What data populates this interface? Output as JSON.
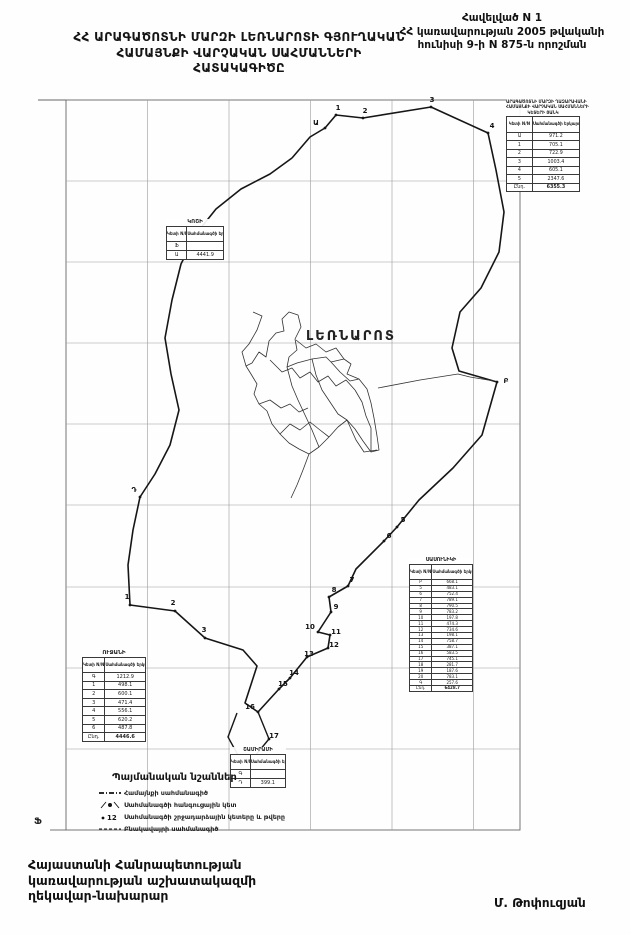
{
  "colors": {
    "ink": "#161616",
    "grid": "#999999",
    "thin": "#333333"
  },
  "header": {
    "appendix": {
      "line1": "Հավելված N 1",
      "line2": "ՀՀ կառավարության 2005 թվականի",
      "line3": "հունիսի 9-ի N 875-ն որոշման"
    },
    "title": {
      "line1": "ՀՀ ԱՐԱԳԱԾՈՏՆԻ ՄԱՐԶԻ ԼԵՌՆԱՐՈՏԻ ԳՅՈՒՂԱԿԱՆ",
      "line2": "ՀԱՄԱՅՆՔԻ ՎԱՐՉԱԿԱՆ ՍԱՀՄԱՆՆԵՐԻ",
      "line3": "ՀԱՏԱԿԱԳԻԾԸ"
    }
  },
  "map": {
    "settlement_label": "ԼԵՌՆԱՐՈՏ",
    "corner_mark": "Ֆ",
    "tables": [
      {
        "id": "t1",
        "title_lines": [
          "ԱՐԱԳԱԾՈՏՆԻ ՄԱՐԶԻ ՂԱԶԱՐԱՎԱՆԻ",
          "ՀԱՄԱՅՆՔԻ ՎԱՐՉԱԿԱՆ ՍԱՀՄԱՆՆԵՐԻ",
          "ԿԵՏԵՐԻ ՑԱՆԿ"
        ],
        "col1": "Կետի N/N",
        "col2": "Սահմանագծի երկարությունը մ",
        "rows": [
          [
            "Ա",
            "971.2"
          ],
          [
            "1",
            "705.1"
          ],
          [
            "2",
            "722.9"
          ],
          [
            "3",
            "1003.4"
          ],
          [
            "4",
            "605.1"
          ],
          [
            "5",
            "2347.6"
          ]
        ],
        "total_label": "Ընդ.",
        "total": "6355.3"
      },
      {
        "id": "t2",
        "title_lines": [
          "ԿՈՇԻ"
        ],
        "col1": "Կետի N/N",
        "col2": "Սահմանագծի երկարությունը մ",
        "rows": [
          [
            "Ֆ",
            ""
          ],
          [
            "Ա",
            "4441.9"
          ]
        ],
        "total_label": "",
        "total": ""
      },
      {
        "id": "t3",
        "title_lines": [
          "ՍԱՍՈՒՆԻԿԻ"
        ],
        "col1": "Կետի N/N",
        "col2": "Սահմանագծի երկարությունը մ",
        "rows": [
          [
            "Բ",
            "668.1"
          ],
          [
            "5",
            "483.1"
          ],
          [
            "6",
            "752.4"
          ],
          [
            "7",
            "789.1"
          ],
          [
            "8",
            "790.5"
          ],
          [
            "9",
            "783.2"
          ],
          [
            "10",
            "197.8"
          ],
          [
            "11",
            "474.3"
          ],
          [
            "12",
            "734.6"
          ],
          [
            "13",
            "198.1"
          ],
          [
            "14",
            "758.7"
          ],
          [
            "15",
            "387.1"
          ],
          [
            "16",
            "583.5"
          ],
          [
            "17",
            "745.1"
          ],
          [
            "18",
            "281.7"
          ],
          [
            "19",
            "187.6"
          ],
          [
            "20",
            "783.1"
          ],
          [
            "Գ",
            "257.6"
          ]
        ],
        "total_label": "Ընդ.",
        "total": "6428.7"
      },
      {
        "id": "t4",
        "title_lines": [
          "ՈՒՋԱՆԻ"
        ],
        "col1": "Կետի N/N",
        "col2": "Սահմանագծի երկարությունը մ",
        "rows": [
          [
            "Գ",
            "1212.9"
          ],
          [
            "1",
            "498.1"
          ],
          [
            "2",
            "600.1"
          ],
          [
            "3",
            "471.4"
          ],
          [
            "4",
            "556.1"
          ],
          [
            "5",
            "620.2"
          ],
          [
            "6",
            "487.8"
          ]
        ],
        "total_label": "Ընդ.",
        "total": "4446.6"
      },
      {
        "id": "t5",
        "title_lines": [
          "ՇԱՄԻՐԱՄԻ"
        ],
        "col1": "Կետի N/N",
        "col2": "Սահմանագծի երկարությունը մ",
        "rows": [
          [
            "Գ",
            ""
          ],
          [
            "Դ",
            "399.1"
          ]
        ],
        "total_label": "",
        "total": ""
      }
    ],
    "legend": {
      "title": "Պայմանական նշաններ",
      "items": [
        {
          "symbol": "community-boundary-line-icon",
          "label": "Համայնքի սահմանագիծ"
        },
        {
          "symbol": "junction-point-icon",
          "label": "Սահմանագծի հանգուցային կետ"
        },
        {
          "symbol": "turning-point-number-icon",
          "label": "Սահմանագծի շրջադարձային կետերը և թվերը"
        },
        {
          "symbol": "settlement-boundary-line-icon",
          "label": "Բնակավայրի սահմանագիծ"
        }
      ]
    },
    "points": [
      {
        "label": "Ա",
        "x": 316,
        "y": 127
      },
      {
        "label": "1",
        "x": 338,
        "y": 112
      },
      {
        "label": "2",
        "x": 365,
        "y": 115
      },
      {
        "label": "3",
        "x": 432,
        "y": 104
      },
      {
        "label": "4",
        "x": 492,
        "y": 130
      },
      {
        "label": "Բ",
        "x": 506,
        "y": 385
      },
      {
        "label": "5",
        "x": 403,
        "y": 524
      },
      {
        "label": "6",
        "x": 389,
        "y": 540
      },
      {
        "label": "7",
        "x": 352,
        "y": 584
      },
      {
        "label": "8",
        "x": 334,
        "y": 594
      },
      {
        "label": "9",
        "x": 336,
        "y": 611
      },
      {
        "label": "10",
        "x": 310,
        "y": 631
      },
      {
        "label": "11",
        "x": 336,
        "y": 636
      },
      {
        "label": "12",
        "x": 334,
        "y": 649
      },
      {
        "label": "13",
        "x": 309,
        "y": 658
      },
      {
        "label": "14",
        "x": 294,
        "y": 677
      },
      {
        "label": "15",
        "x": 283,
        "y": 688
      },
      {
        "label": "16",
        "x": 250,
        "y": 711
      },
      {
        "label": "17",
        "x": 274,
        "y": 740
      },
      {
        "label": "Գ",
        "x": 240,
        "y": 764
      },
      {
        "label": "3",
        "x": 204,
        "y": 634
      },
      {
        "label": "2",
        "x": 173,
        "y": 607
      },
      {
        "label": "1",
        "x": 127,
        "y": 601
      },
      {
        "label": "Դ",
        "x": 134,
        "y": 494
      }
    ],
    "geometry": {
      "frame": {
        "x1": 66,
        "y1": 100,
        "x2": 520,
        "y2": 830
      },
      "frame_top_ext_x": 38,
      "grid_x": [
        147.5,
        229,
        310.5,
        392,
        473.5
      ],
      "grid_y": [
        181,
        262,
        343,
        424,
        505,
        587,
        668,
        749
      ],
      "boundary": [
        [
          292,
          158
        ],
        [
          310,
          137
        ],
        [
          325,
          128
        ],
        [
          336,
          115
        ],
        [
          363,
          118
        ],
        [
          431,
          107
        ],
        [
          488,
          133
        ],
        [
          496,
          170
        ],
        [
          504,
          212
        ],
        [
          499,
          252
        ],
        [
          481,
          288
        ],
        [
          460,
          312
        ],
        [
          452,
          348
        ],
        [
          459,
          371
        ],
        [
          497,
          382
        ],
        [
          482,
          435
        ],
        [
          453,
          468
        ],
        [
          419,
          500
        ],
        [
          397,
          527
        ],
        [
          384,
          541
        ],
        [
          356,
          569
        ],
        [
          348,
          586
        ],
        [
          329,
          597
        ],
        [
          331,
          612
        ],
        [
          318,
          632
        ],
        [
          330,
          635
        ],
        [
          328,
          648
        ],
        [
          307,
          657
        ],
        [
          290,
          678
        ],
        [
          279,
          689
        ],
        [
          258,
          712
        ],
        [
          245,
          703
        ],
        [
          257,
          666
        ],
        [
          243,
          650
        ],
        [
          205,
          638
        ],
        [
          175,
          611
        ],
        [
          130,
          605
        ],
        [
          128,
          565
        ],
        [
          133,
          530
        ],
        [
          140,
          497
        ],
        [
          155,
          474
        ],
        [
          170,
          445
        ],
        [
          179,
          410
        ],
        [
          171,
          374
        ],
        [
          165,
          338
        ],
        [
          172,
          300
        ],
        [
          181,
          264
        ],
        [
          196,
          234
        ],
        [
          216,
          209
        ],
        [
          241,
          189
        ],
        [
          270,
          174
        ],
        [
          292,
          158
        ]
      ],
      "boundary_spurs": [
        "M258 712 L269 739 L245 768",
        "M245 768 L228 737 L237 713"
      ],
      "settlement_paths": [
        "M253 312 L262 316 L257 330 L249 344 L242 352 L246 366 L252 363 L259 352 L266 357 L269 341 L276 333 L284 331 L282 319 L289 312 L298 315 L301 327 L295 339 L297 350 L289 357 L287 367 L297 363 L312 359 L326 357 L331 362 L344 359 L351 364 L347 374 L359 379 L367 389 L371 403 L374 418 L377 436 L379 450 L371 452 L363 441 L355 429 L347 420 L338 427 L329 437 L319 447 L309 454 L299 449 L289 443 L280 434 L272 424 L267 411 L259 404 L254 394 L257 384 L251 374 L246 366",
        "M270 360 L282 372 L292 368 L300 378 L310 372 L318 382 L328 376 L336 386 L346 380 L355 390",
        "M287 367 L292 386 L298 400 L305 415 L312 430 L319 447",
        "M312 359 L316 375 L322 390 L330 402 L338 414 L347 420",
        "M331 362 L340 372 L350 381 L359 379",
        "M259 404 L270 400 L281 408 L290 404 L299 412 L308 408",
        "M280 434 L290 424 L300 430 L310 422 L320 430 L329 437",
        "M296 340 L306 348 L316 344 L326 352 L336 348 L344 359",
        "M355 390 L362 402 L366 416 L371 428 L371 452",
        "M347 420 L356 440 L364 452 L377 450",
        "M309 454 L303 470 L297 485 L291 498",
        "M378 388 L420 380 L458 374 L470 377 L494 381"
      ],
      "dots": [
        [
          325,
          128
        ],
        [
          336,
          115
        ],
        [
          363,
          118
        ],
        [
          431,
          107
        ],
        [
          488,
          133
        ],
        [
          497,
          382
        ],
        [
          397,
          527
        ],
        [
          384,
          541
        ],
        [
          348,
          586
        ],
        [
          329,
          597
        ],
        [
          331,
          612
        ],
        [
          318,
          632
        ],
        [
          330,
          635
        ],
        [
          328,
          648
        ],
        [
          307,
          657
        ],
        [
          290,
          678
        ],
        [
          279,
          689
        ],
        [
          258,
          712
        ],
        [
          269,
          739
        ],
        [
          245,
          768
        ],
        [
          205,
          638
        ],
        [
          175,
          611
        ],
        [
          130,
          605
        ],
        [
          140,
          497
        ]
      ]
    }
  },
  "footer": {
    "left_line1": "Հայաստանի Հանրապետության",
    "left_line2": "կառավարության աշխատակազմի",
    "left_line3": "ղեկավար-նախարար",
    "signature": "Մ. Թոփուզյան"
  }
}
